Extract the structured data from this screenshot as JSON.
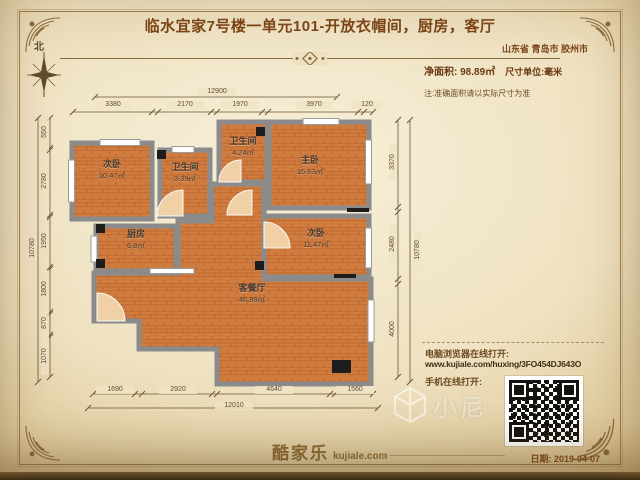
{
  "header": {
    "title": "临水宜家7号楼一单元101-开放衣帽间，厨房，客厅",
    "location": "山东省 青岛市 胶州市",
    "net_area": "净面积: 98.89㎡",
    "unit": "尺寸单位:毫米",
    "note": "注:准确面积请以实际尺寸为准",
    "compass": "北"
  },
  "rooms": [
    {
      "name": "次卧",
      "area": "10.47㎡"
    },
    {
      "name": "卫生间",
      "area": "3.39㎡"
    },
    {
      "name": "卫生间",
      "area": "4.24㎡"
    },
    {
      "name": "主卧",
      "area": "15.63㎡"
    },
    {
      "name": "厨房",
      "area": "6.8㎡"
    },
    {
      "name": "次卧",
      "area": "11.47㎡"
    },
    {
      "name": "客餐厅",
      "area": "46.89㎡"
    }
  ],
  "dimensions": {
    "top_overall": "12900",
    "top_segments": [
      "3380",
      "2170",
      "1970",
      "3970",
      "120"
    ],
    "left_overall": "10780",
    "left_segments": [
      "550",
      "2780",
      "1950",
      "1800",
      "870",
      "1070"
    ],
    "right_overall": "10780",
    "right_segments": [
      "3370",
      "2480",
      "4000"
    ],
    "bottom_overall": "12010",
    "bottom_segments": [
      "1690",
      "2920",
      "4640",
      "1560"
    ]
  },
  "footer": {
    "pc_label": "电脑浏览器在线打开:",
    "url": "www.kujiale.com/huxing/3FO454DJ643O",
    "mobile_label": "手机在线打开:",
    "logo": "酷家乐",
    "logo_domain": "kujiale.com",
    "date": "日期: 2019-04-07",
    "watermark": "小尼"
  },
  "colors": {
    "accent": "#7b4316",
    "wall": "#8b8b8b",
    "floor": "#d07c3e",
    "paper": "#efe2c1",
    "qr_dark": "#151310"
  }
}
